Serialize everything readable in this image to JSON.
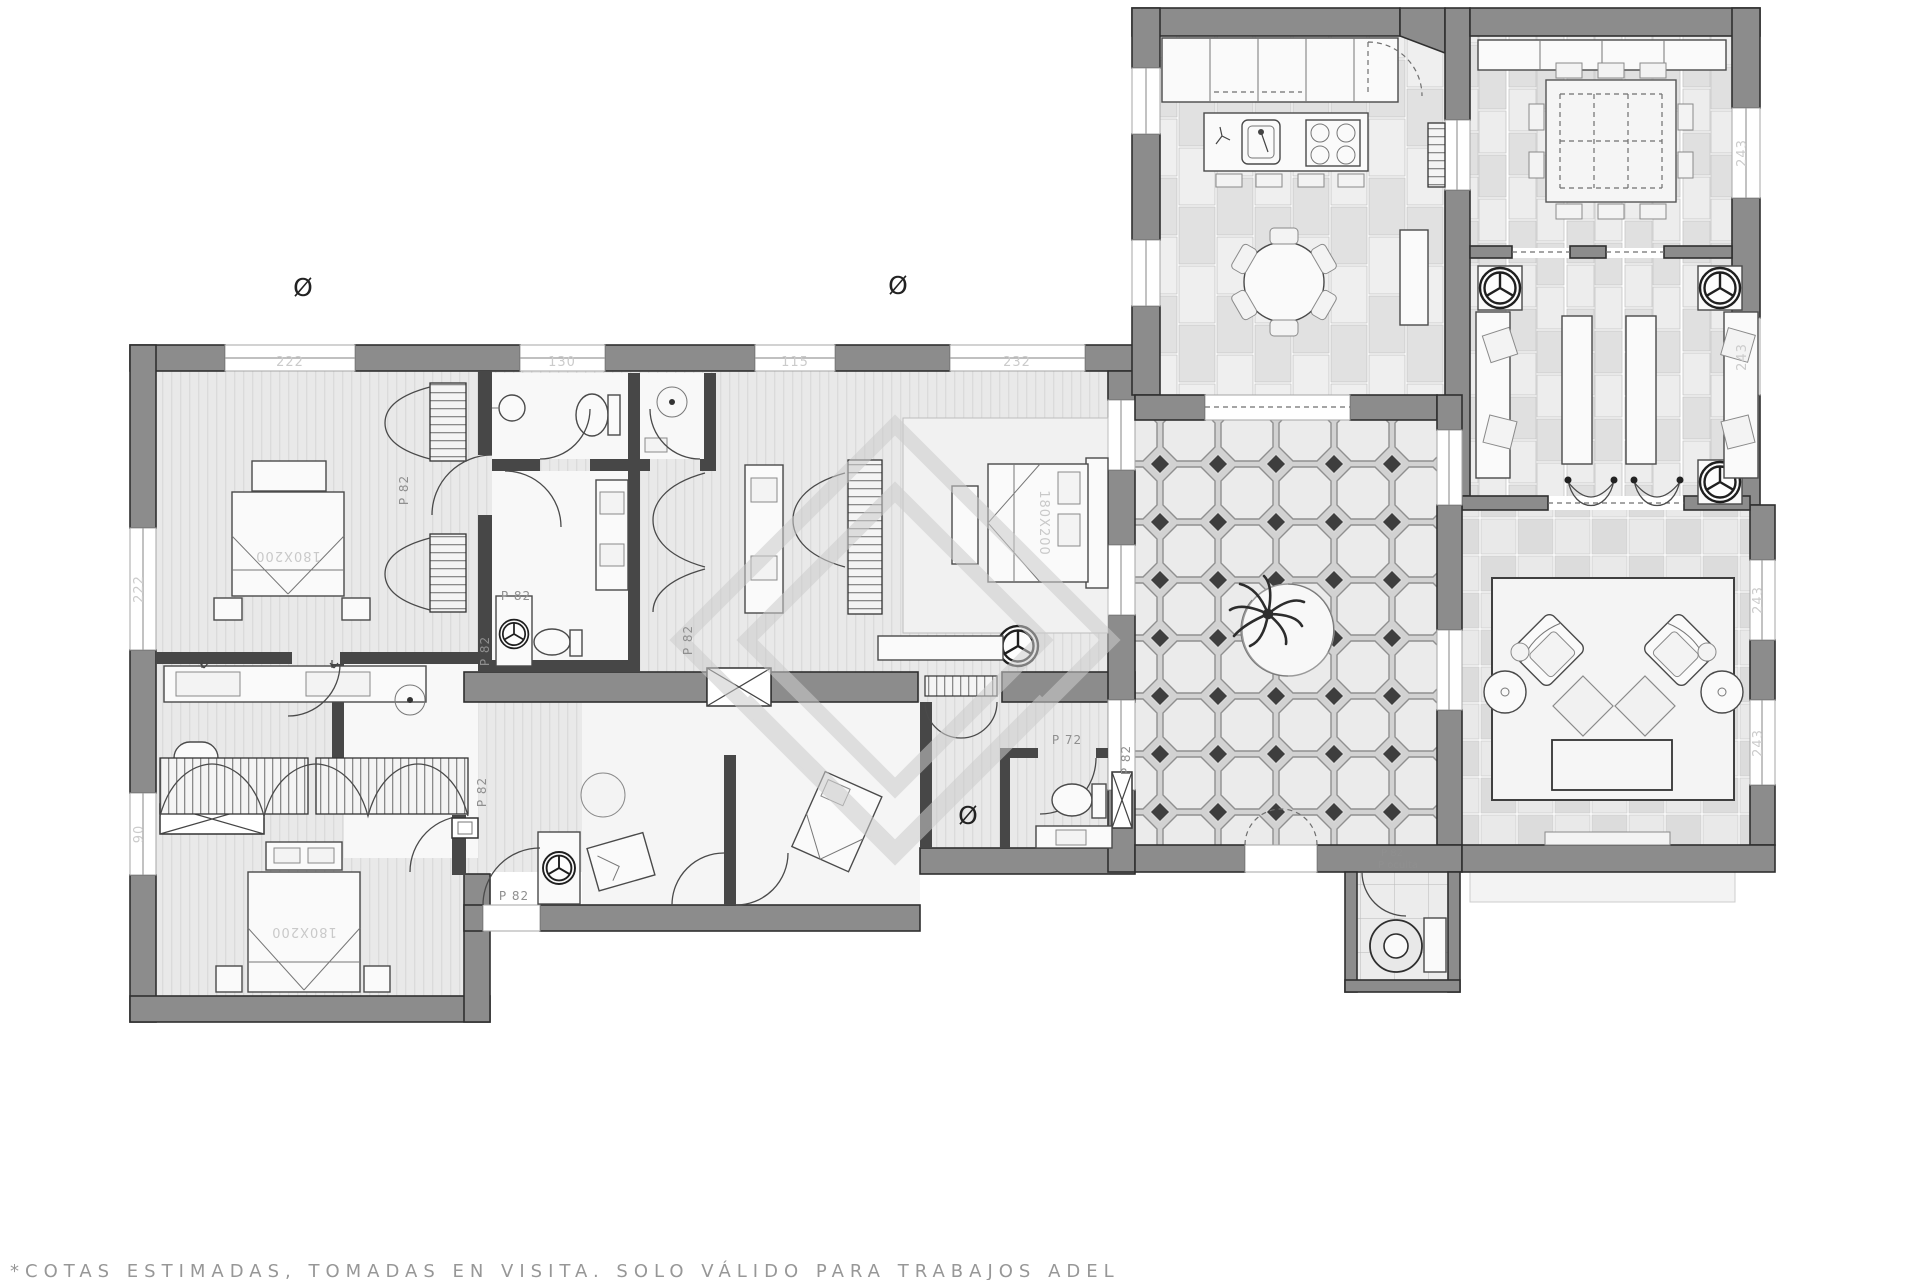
{
  "document": {
    "background": "#ffffff",
    "footer_note": "*COTAS ESTIMADAS, TOMADAS EN VISITA. SOLO VÁLIDO PARA TRABAJOS ADEL"
  },
  "plan": {
    "type": "architectural-floor-plan",
    "colors": {
      "wall": "#8c8c8c",
      "partition": "#474747",
      "outline": "#2f2f2f",
      "floor_light": "#e9e9e9",
      "tile_dark": "#3e3e3e",
      "watermark": "#cccccc"
    },
    "labels": {
      "diameter": "Ø",
      "bed_size": "180X200",
      "door_p82": "P 82",
      "door_p72": "P 72",
      "door_hidden": "P oculta",
      "dim_222": "222",
      "dim_130": "130",
      "dim_115": "115",
      "dim_232": "232",
      "dim_90": "90",
      "dim_243": "243"
    }
  }
}
